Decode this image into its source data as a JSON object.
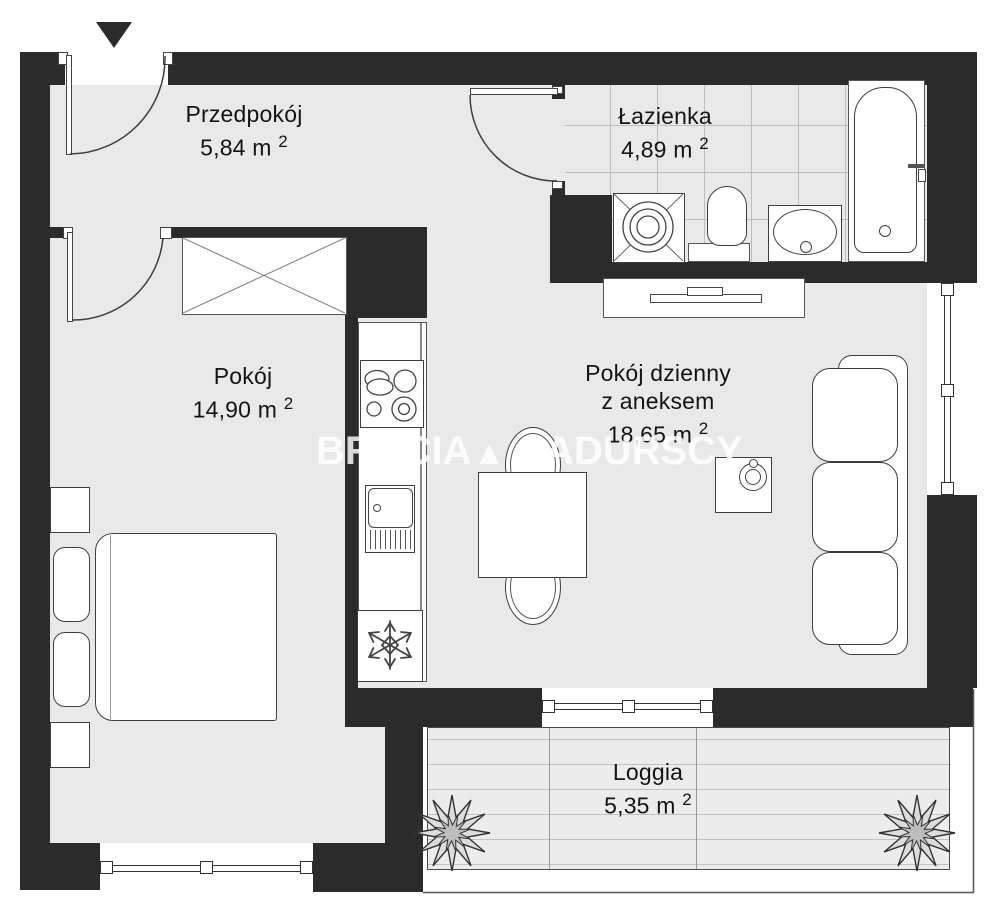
{
  "plan": {
    "title": "apartment-floor-plan",
    "watermark": {
      "part1": "BRACIA",
      "triangle": "▲",
      "part2": "SADURSCY"
    },
    "rooms": {
      "hallway": {
        "name": "Przedpokój",
        "area": "5,84 m",
        "sup": "2"
      },
      "bathroom": {
        "name": "Łazienka",
        "area": "4,89 m",
        "sup": "2"
      },
      "bedroom": {
        "name": "Pokój",
        "area": "14,90 m",
        "sup": "2"
      },
      "living": {
        "name": "Pokój dzienny",
        "name2": "z aneksem",
        "area": "18,65 m",
        "sup": "2"
      },
      "loggia": {
        "name": "Loggia",
        "area": "5,35 m",
        "sup": "2"
      }
    },
    "colors": {
      "wall": "#2b2b2b",
      "floor": "#e9e9e9",
      "fixture_outline": "#3f3f3f"
    }
  }
}
